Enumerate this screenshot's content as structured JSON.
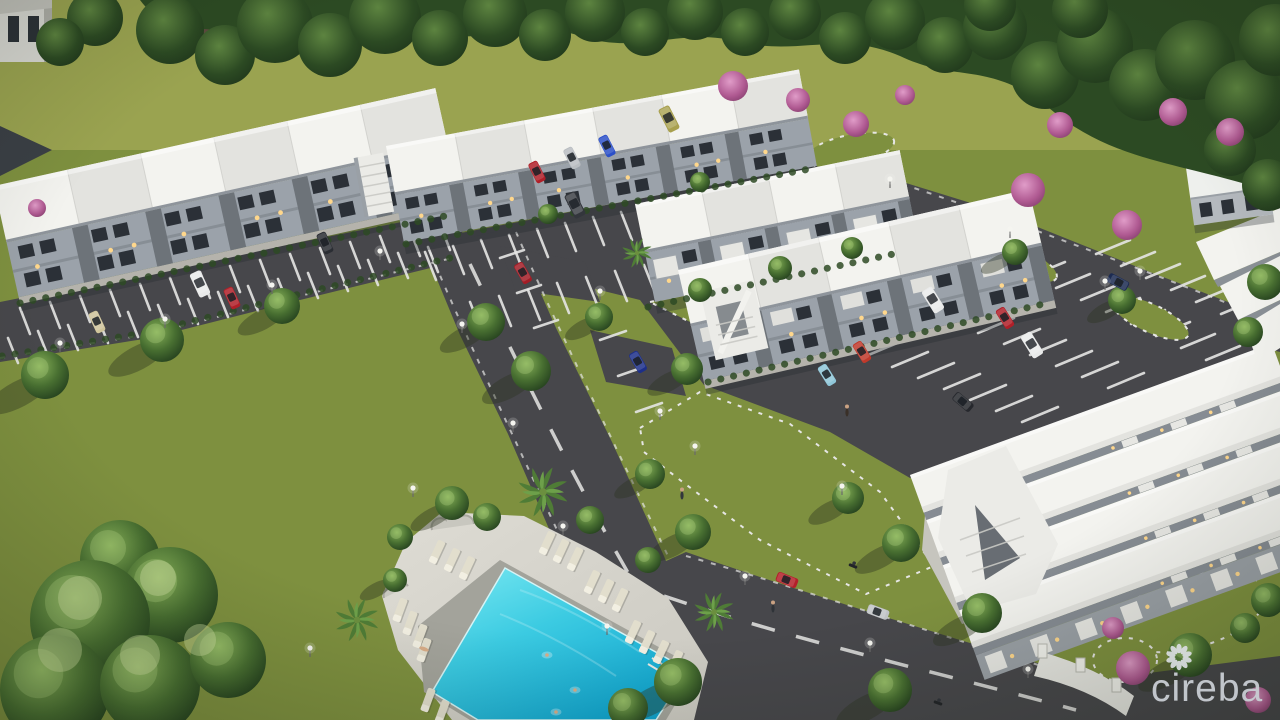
{
  "image": {
    "kind": "3d-architectural-aerial-rendering",
    "subject": "Townhouse community site rendering with parking lots, landscaped road, lawns and swimming pool",
    "time_of_day": "dusk, unit lights on"
  },
  "watermark": {
    "text": "cireba",
    "logo": "petal-rosette-flower",
    "position": "bottom-right"
  },
  "colors": {
    "field": "#9aa350",
    "lawn": "#7e903f",
    "lawn_dark": "#5e732f",
    "tree_light": "#86b058",
    "tree_mid": "#486f31",
    "tree_dark": "#24401e",
    "pink_light": "#e09cc8",
    "pink_dark": "#8d4474",
    "asphalt": "#47474b",
    "marking": "#e6e6e4",
    "roof": "#f3f3ef",
    "roof_shade": "#e3e3df",
    "facade": "#9ba2aa",
    "facade_dark": "#6d7379",
    "window": "#2b3037",
    "unit_light": "#ffd78c",
    "deck": "#d9d7cf",
    "coping": "#a3a39b",
    "chair": "#e2decd",
    "pool_light": "#7ae9f2",
    "pool_mid": "#3ccbe2",
    "pool_deep": "#0fa3cd",
    "watermark": "#c9cdd3"
  },
  "scene": {
    "buildings": [
      {
        "name": "townhouse-row-west",
        "type": "2-storey townhouse block",
        "units": 6,
        "roof": "white",
        "walls": "grey"
      },
      {
        "name": "townhouse-row-north",
        "type": "2-storey townhouse block with end stair",
        "units": 6,
        "roof": "white",
        "walls": "grey"
      },
      {
        "name": "townhouse-row-center",
        "type": "2-storey townhouse block with balconies and stairs",
        "units": 4,
        "roof": "white",
        "walls": "grey"
      },
      {
        "name": "townhouse-row-east",
        "type": "2-storey townhouse block with entry stair",
        "units": 5,
        "roof": "white",
        "walls": "grey"
      },
      {
        "name": "townhouse-row-southeast",
        "type": "2-storey townhouse block seen from above, balcony row",
        "units": 8,
        "roof": "white",
        "walls": "grey"
      },
      {
        "name": "townhouse-row-far-east",
        "type": "partial roofs at right edge",
        "units": 3,
        "roof": "white"
      },
      {
        "name": "neighbour-house-northeast",
        "type": "existing house beyond tree line"
      },
      {
        "name": "neighbour-house-northwest",
        "type": "existing house, partially visible at corner"
      }
    ],
    "pool": {
      "shape": "rectangular",
      "water": "turquoise",
      "swimmers": 3,
      "lounge_chairs": 18,
      "sunbather": 1,
      "features": [
        "paved deck",
        "scalloped stone planters",
        "palm trees",
        "round clipped trees"
      ]
    },
    "roads": {
      "main_road": "diagonal two-lane road with dashed centre line and parallel parking bays",
      "south_road": "curved road to gated entrance at bottom right",
      "parking_lots": [
        "west lot",
        "north lot",
        "east lot",
        "northeast lot"
      ],
      "street_lamps": 21
    },
    "landscaping": {
      "tree_line": "dense forest along north boundary",
      "street_trees": "round clipped trees with long dusk shadows",
      "flowering_trees": "pink bougainvillea accents",
      "lawns": "large open lawns left and right of road"
    },
    "people": {
      "pedestrians": 3,
      "swimmers": 3,
      "sunbathers": 1
    },
    "vehicles": [
      {
        "type": "sedan",
        "color": "beige",
        "hex": "#cfc49a",
        "location": "west lot",
        "state": "parked"
      },
      {
        "type": "van",
        "color": "white",
        "hex": "#e9eaea",
        "location": "west lot",
        "state": "parked"
      },
      {
        "type": "sedan",
        "color": "red",
        "hex": "#b01f28",
        "location": "west lot",
        "state": "parked"
      },
      {
        "type": "sedan",
        "color": "dark grey",
        "hex": "#2a2d33",
        "location": "west lot",
        "state": "parked"
      },
      {
        "type": "sedan",
        "color": "red",
        "hex": "#b01f28",
        "location": "north lot",
        "state": "parked"
      },
      {
        "type": "sedan",
        "color": "silver",
        "hex": "#b9bdc1",
        "location": "north lot",
        "state": "parked"
      },
      {
        "type": "sedan",
        "color": "blue",
        "hex": "#2c50c8",
        "location": "north lot",
        "state": "parked"
      },
      {
        "type": "suv",
        "color": "dark grey",
        "hex": "#33363c",
        "location": "north lot",
        "state": "parked"
      },
      {
        "type": "van",
        "color": "olive",
        "hex": "#a8a04e",
        "location": "north lot",
        "state": "parked"
      },
      {
        "type": "sedan",
        "color": "red",
        "hex": "#a31d26",
        "location": "main road bay",
        "state": "parked"
      },
      {
        "type": "sedan",
        "color": "navy",
        "hex": "#1d2f8a",
        "location": "main road bay",
        "state": "parked"
      },
      {
        "type": "van",
        "color": "white",
        "hex": "#e9eaea",
        "location": "east lot",
        "state": "parked"
      },
      {
        "type": "sedan",
        "color": "red",
        "hex": "#b01f28",
        "location": "east lot",
        "state": "parked"
      },
      {
        "type": "van",
        "color": "white",
        "hex": "#e9eaea",
        "location": "east lot",
        "state": "parked"
      },
      {
        "type": "sedan",
        "color": "red",
        "hex": "#c0392b",
        "location": "east lot south row",
        "state": "parked"
      },
      {
        "type": "sedan",
        "color": "light blue",
        "hex": "#8fc6d8",
        "location": "east lot south row",
        "state": "parked"
      },
      {
        "type": "sedan",
        "color": "black",
        "hex": "#26282d",
        "location": "east lot aisle",
        "state": "parked"
      },
      {
        "type": "sedan",
        "color": "dark blue",
        "hex": "#1c2b52",
        "location": "northeast lot",
        "state": "parked"
      },
      {
        "type": "sedan",
        "color": "red",
        "hex": "#b3202a",
        "location": "south road",
        "state": "driving"
      },
      {
        "type": "sedan",
        "color": "silver",
        "hex": "#c0c3c6",
        "location": "south road",
        "state": "driving"
      },
      {
        "type": "motorcycle",
        "color": "black",
        "hex": "#222428",
        "location": "south road",
        "state": "driving"
      },
      {
        "type": "motorcycle",
        "color": "black",
        "hex": "#222428",
        "location": "south road entrance",
        "state": "driving"
      }
    ]
  }
}
